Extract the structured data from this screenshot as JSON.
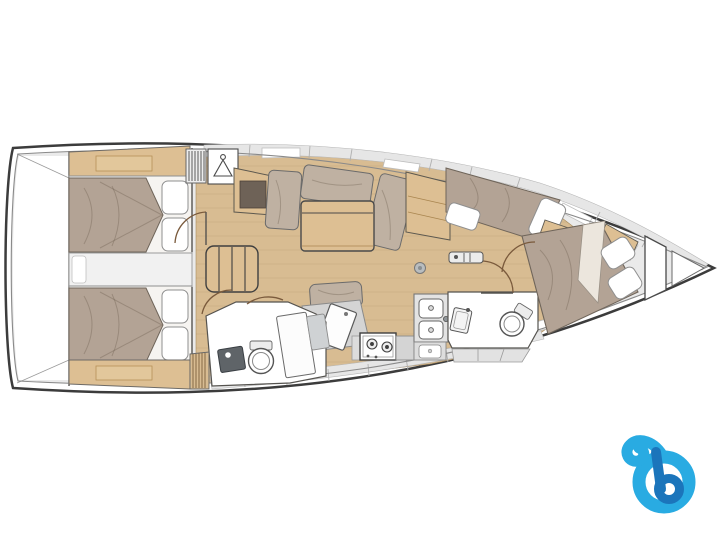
{
  "page": {
    "background_color": "#ffffff",
    "artwork": "sailing-yacht-interior-floor-plan"
  },
  "colors": {
    "hull_outline": "#3c3c3c",
    "hull_inner_line": "#8a8a8a",
    "deck_gray": "#eaeaea",
    "band_gray": "#e6e6e6",
    "stern_white": "#ffffff",
    "floor_wood": "#d8bc92",
    "furniture_wood": "#ddbf93",
    "shelf_inner_wood": "#e2c79b",
    "wood_dark_recess": "#6e6257",
    "mattress_taupe": "#b3a395",
    "cushion_taupe": "#bfb1a2",
    "bedding_white": "#ffffff",
    "sheet_cream": "#ece6dd",
    "bed_base_white": "#f6f4f1",
    "engine_box_gray": "#f1f1f1",
    "fixture_white": "#fdfdfd",
    "fixture_gray": "#d4d4d4",
    "counter_gray": "#dcdcdc",
    "dark_counter": "#5f6468",
    "door_arc": "#7a5a3c",
    "hatch_circle": "#b9bdbf",
    "logo_light_blue": "#29abe2",
    "logo_dark_blue": "#1b75bb"
  },
  "areas": [
    {
      "id": "aft-cabin-port"
    },
    {
      "id": "aft-cabin-starboard"
    },
    {
      "id": "engine-compartment"
    },
    {
      "id": "companionway"
    },
    {
      "id": "salon"
    },
    {
      "id": "nav-station"
    },
    {
      "id": "galley"
    },
    {
      "id": "aft-head"
    },
    {
      "id": "forward-head"
    },
    {
      "id": "forward-cabin"
    },
    {
      "id": "anchor-locker"
    }
  ],
  "logo": {
    "id": "boataround-logo",
    "letter": "b"
  }
}
